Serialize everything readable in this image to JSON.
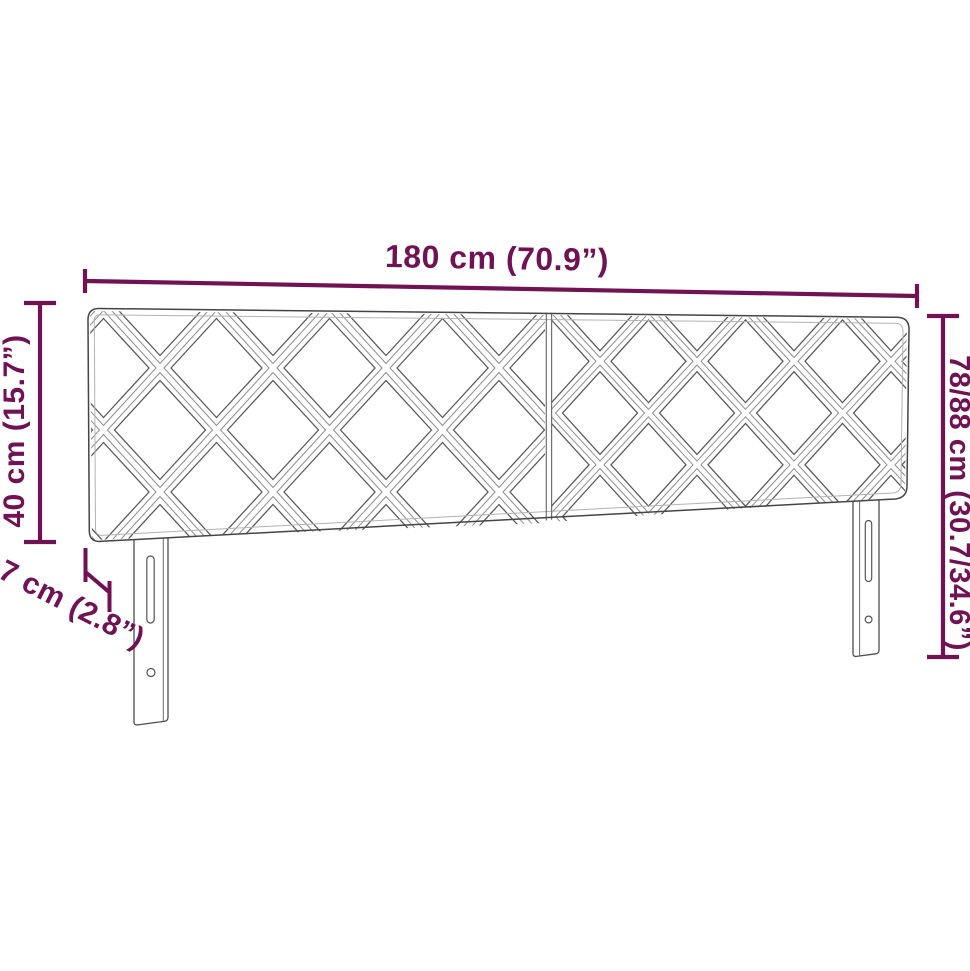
{
  "page": {
    "background_color": "#ffffff"
  },
  "diagram": {
    "accent_color": "#701254",
    "line_color": "#4a4a4a",
    "labels": {
      "width": "180 cm (70.9”)",
      "height": "40 cm (15.7”)",
      "depth": "7 cm (2.8”)",
      "adjustable_height": "78/88 cm (30.7/34.6”)"
    }
  }
}
